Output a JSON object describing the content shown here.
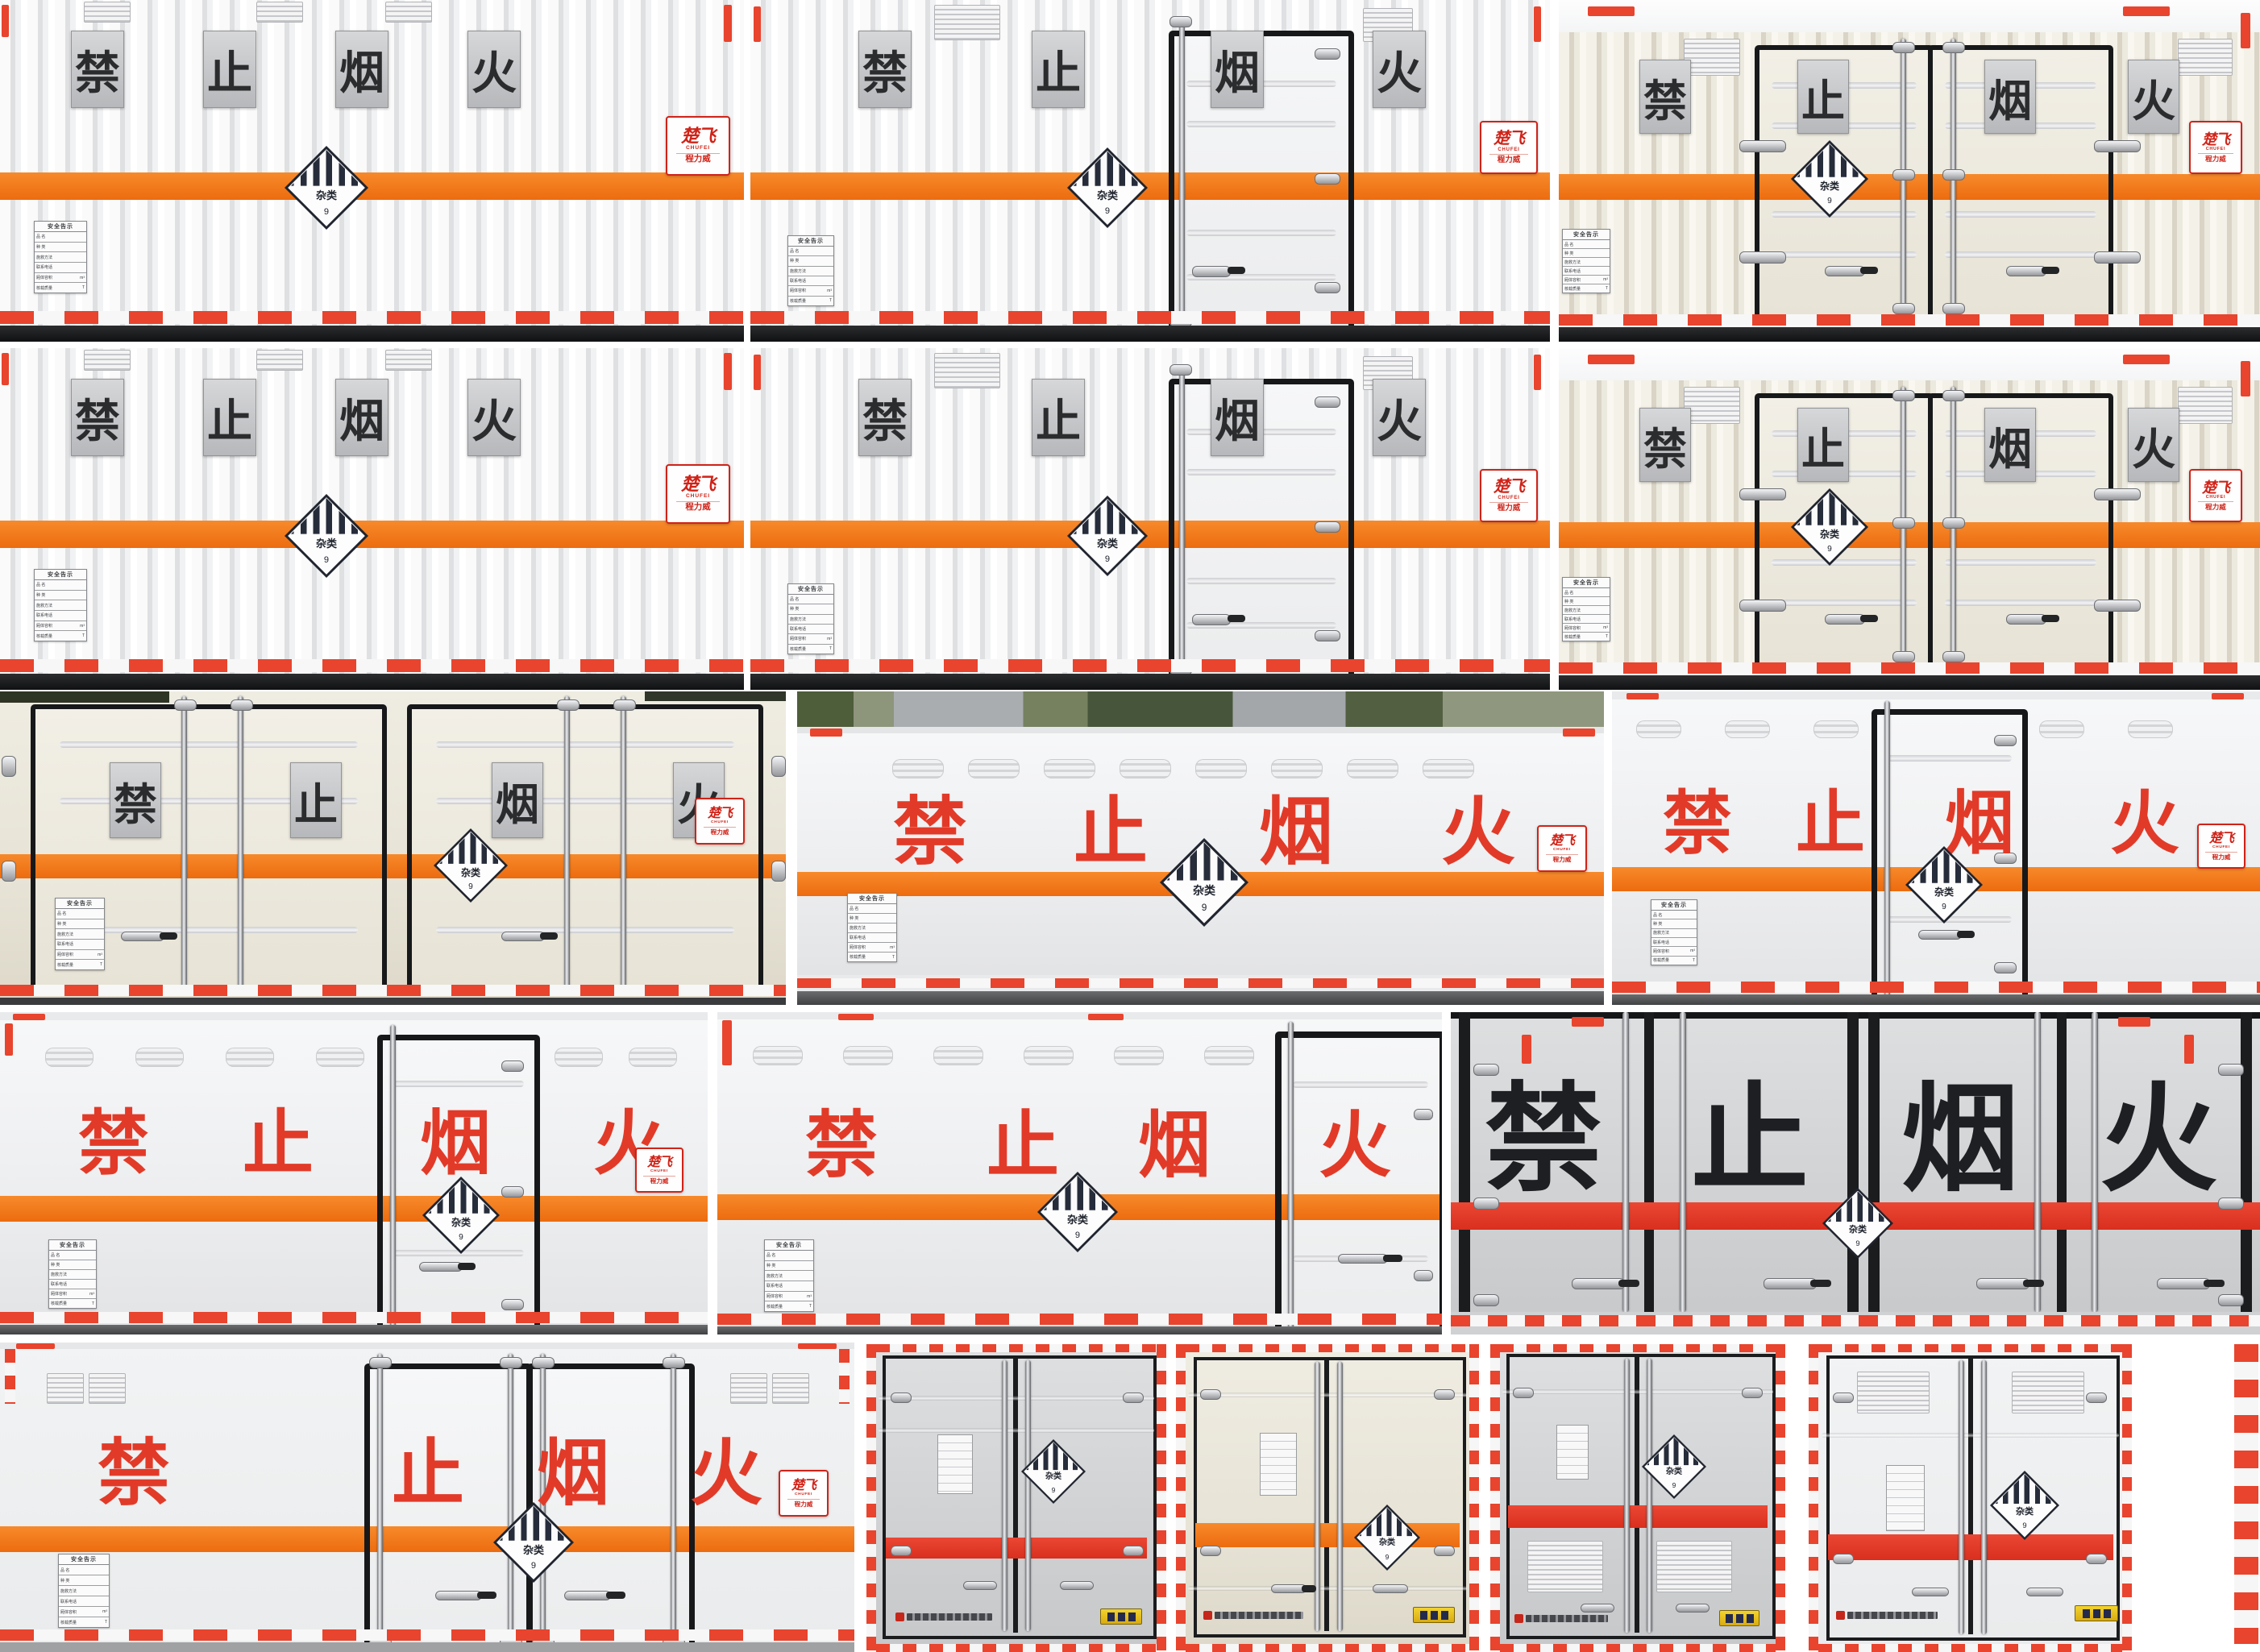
{
  "shared": {
    "chars": [
      "禁",
      "止",
      "烟",
      "火"
    ],
    "placard": {
      "cls": "杂类",
      "num": "9"
    },
    "plate": {
      "title": "安全告示",
      "rows": [
        "品 名",
        "种 类",
        "施救方法",
        "联系电话",
        "厢体容积",
        "核载质量"
      ],
      "unit_volume": "m³",
      "unit_weight": "T"
    },
    "logo": {
      "brand": "楚飞",
      "brand_en": "CHUFEI",
      "sub": "程力威",
      "sub_en": "CHENGLIWEI"
    }
  },
  "colors": {
    "stripe_orange": "#ee7114",
    "stripe_red": "#e0382a",
    "ban_text_red": "#e23a28",
    "ban_plate_silver": "#c6c8ca",
    "ban_char_dark": "#2b2c2e",
    "placard_navy": "#20242e",
    "reflective_red": "#e8442e",
    "logo_red": "#cf2318",
    "temp_plate_yellow": "#e6c51f"
  }
}
